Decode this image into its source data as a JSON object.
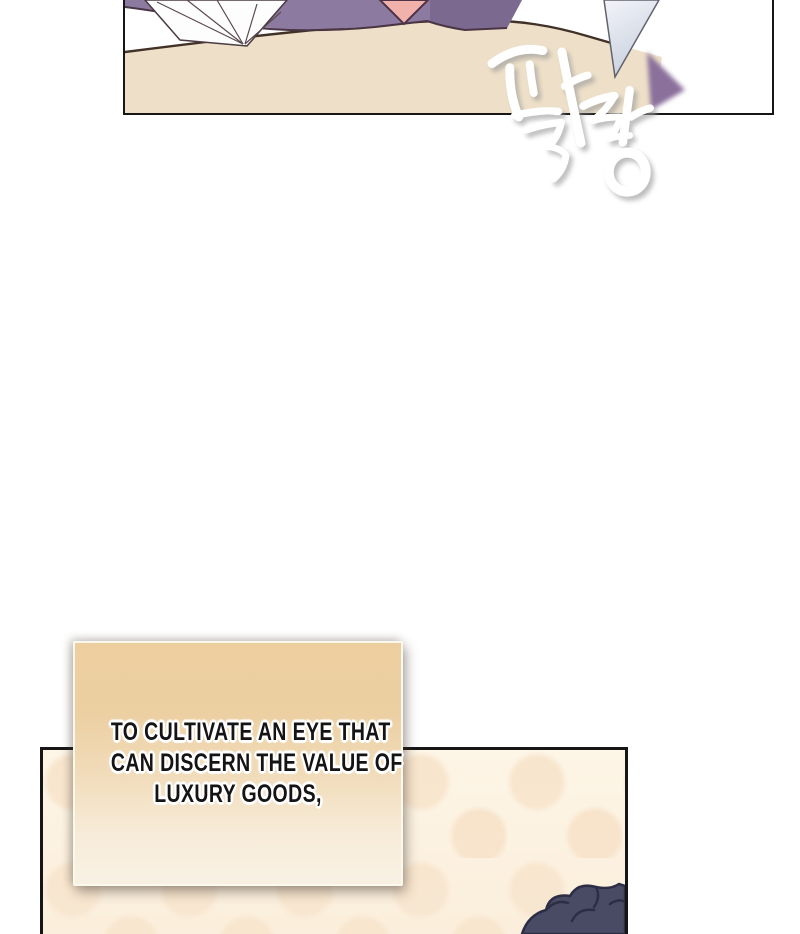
{
  "page": {
    "kind": "webtoon-comic-page",
    "background_color": "#ffffff"
  },
  "top_panel": {
    "description": "close-up of purple garment, white fabric folds and pink skin above a tan table surface; a pale paper sliver flutters at right",
    "colors": {
      "table_surface": "#eee0c8",
      "garment_purple": "#8d7aa0",
      "garment_purple_dark": "#7c6990",
      "skin_pink": "#f0b2aa",
      "fabric_white": "#fdfdfd",
      "paper_blue": "#d7dde8",
      "outline": "#4a3544",
      "panel_border": "#161616"
    }
  },
  "sfx": {
    "text": "팔랑",
    "color": "#ffffff",
    "shadow_color": "#9b9b9b"
  },
  "caption": {
    "lines": [
      "TO CULTIVATE AN EYE THAT",
      "CAN DISCERN THE VALUE OF",
      "LUXURY GOODS,"
    ],
    "text_color": "#141414",
    "box_top_color": "#edcf9f",
    "box_bottom_color": "#f8f1e3"
  },
  "bottom_panel": {
    "description": "cream background with faint peach polka dots; dark curly hair entering from bottom-right corner",
    "colors": {
      "background": "#fdf5e6",
      "dots": "#f8e5cd",
      "hair_fill": "#494b64",
      "hair_outline": "#2c2e45",
      "panel_border": "#161616"
    }
  }
}
